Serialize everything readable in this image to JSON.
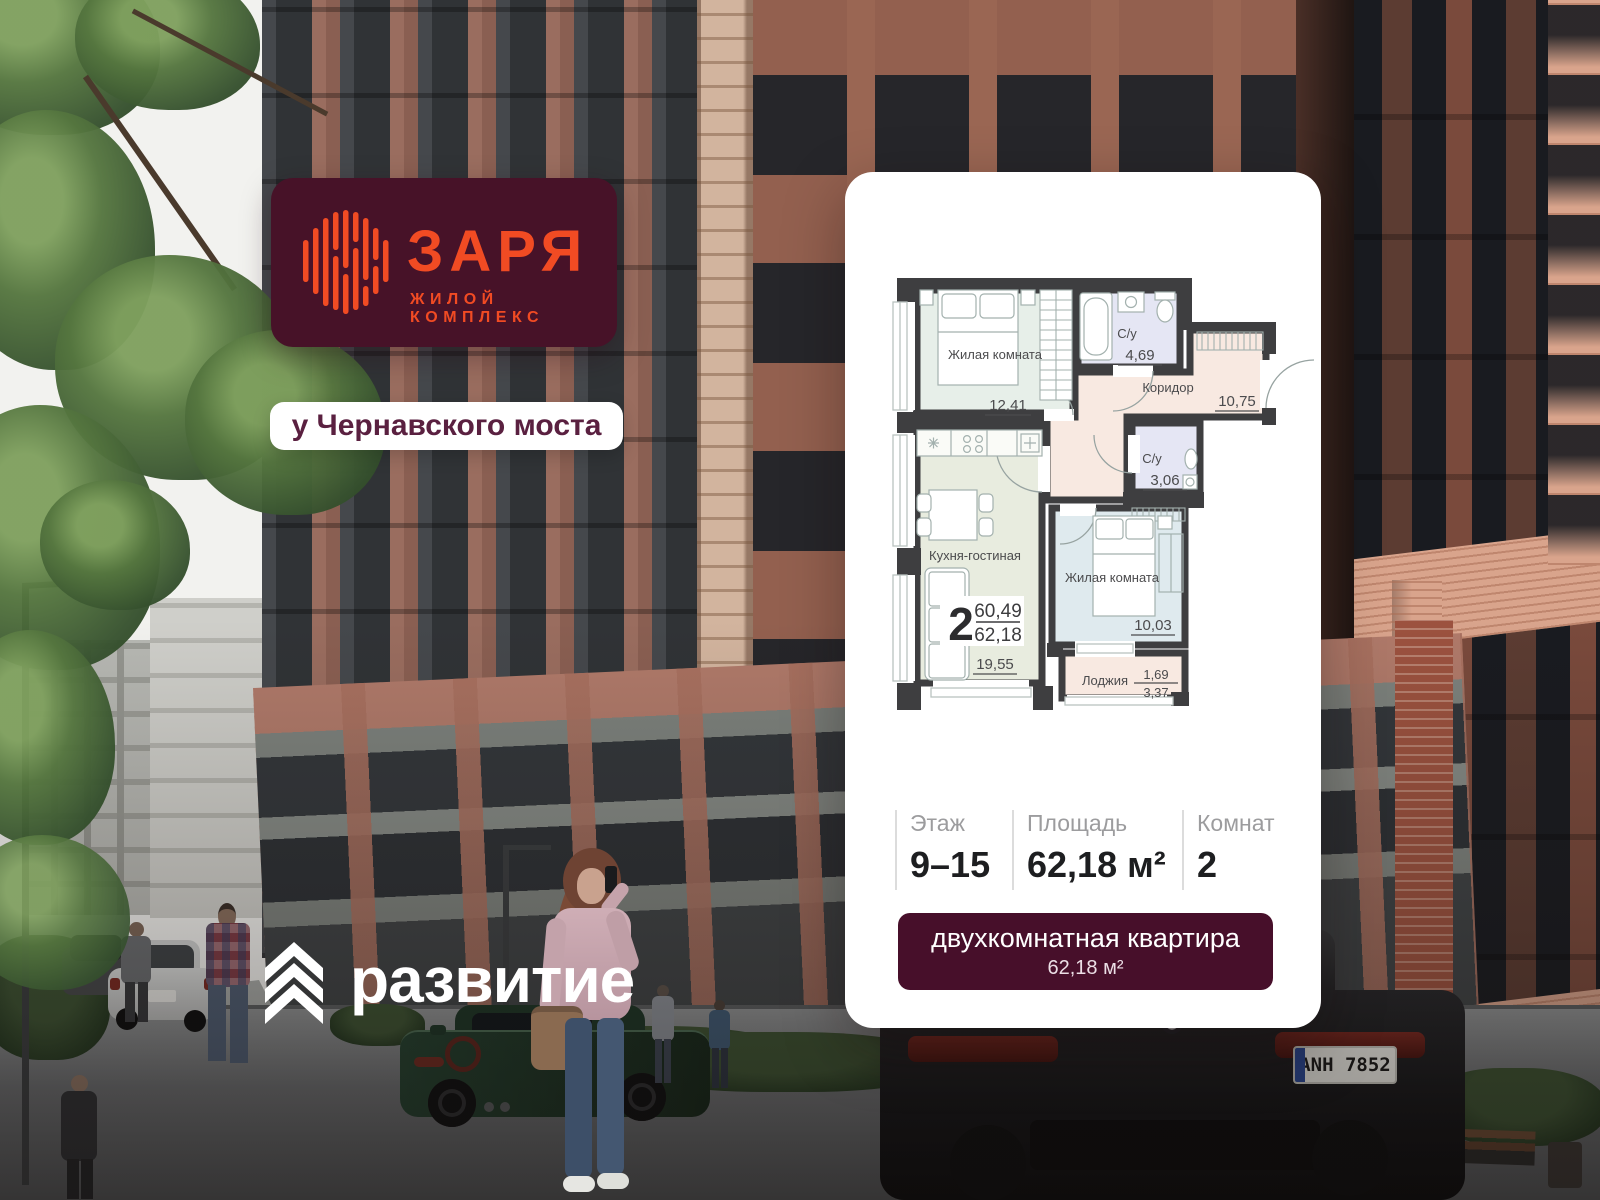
{
  "brand": {
    "name": "ЗАРЯ",
    "tagline": "ЖИЛОЙ КОМПЛЕКС",
    "location_badge": "у Чернавского моста",
    "developer": "развитие",
    "colors": {
      "brand_maroon": "#471228",
      "brand_orange": "#f14b23"
    }
  },
  "card": {
    "plan": {
      "rooms": [
        {
          "name": "Жилая комната",
          "area": "12,41"
        },
        {
          "name": "С/у",
          "area": "4,69"
        },
        {
          "name": "Коридор",
          "area": "10,75"
        },
        {
          "name": "С/у",
          "area": "3,06"
        },
        {
          "name": "Кухня-гостиная",
          "area": "19,55"
        },
        {
          "name": "Жилая комната",
          "area": "10,03"
        },
        {
          "name": "Лоджия",
          "area": "1,69",
          "area_total": "3,37"
        }
      ],
      "unit": {
        "rooms_count": "2",
        "living_area": "60,49",
        "total_area": "62,18"
      }
    },
    "stats": [
      {
        "label": "Этаж",
        "value": "9–15"
      },
      {
        "label": "Площадь",
        "value": "62,18 м²"
      },
      {
        "label": "Комнат",
        "value": "2"
      }
    ],
    "badge": {
      "line1": "двухкомнатная квартира",
      "line2": "62,18 м²"
    }
  },
  "scene": {
    "license_plate": "ANH 7852"
  }
}
